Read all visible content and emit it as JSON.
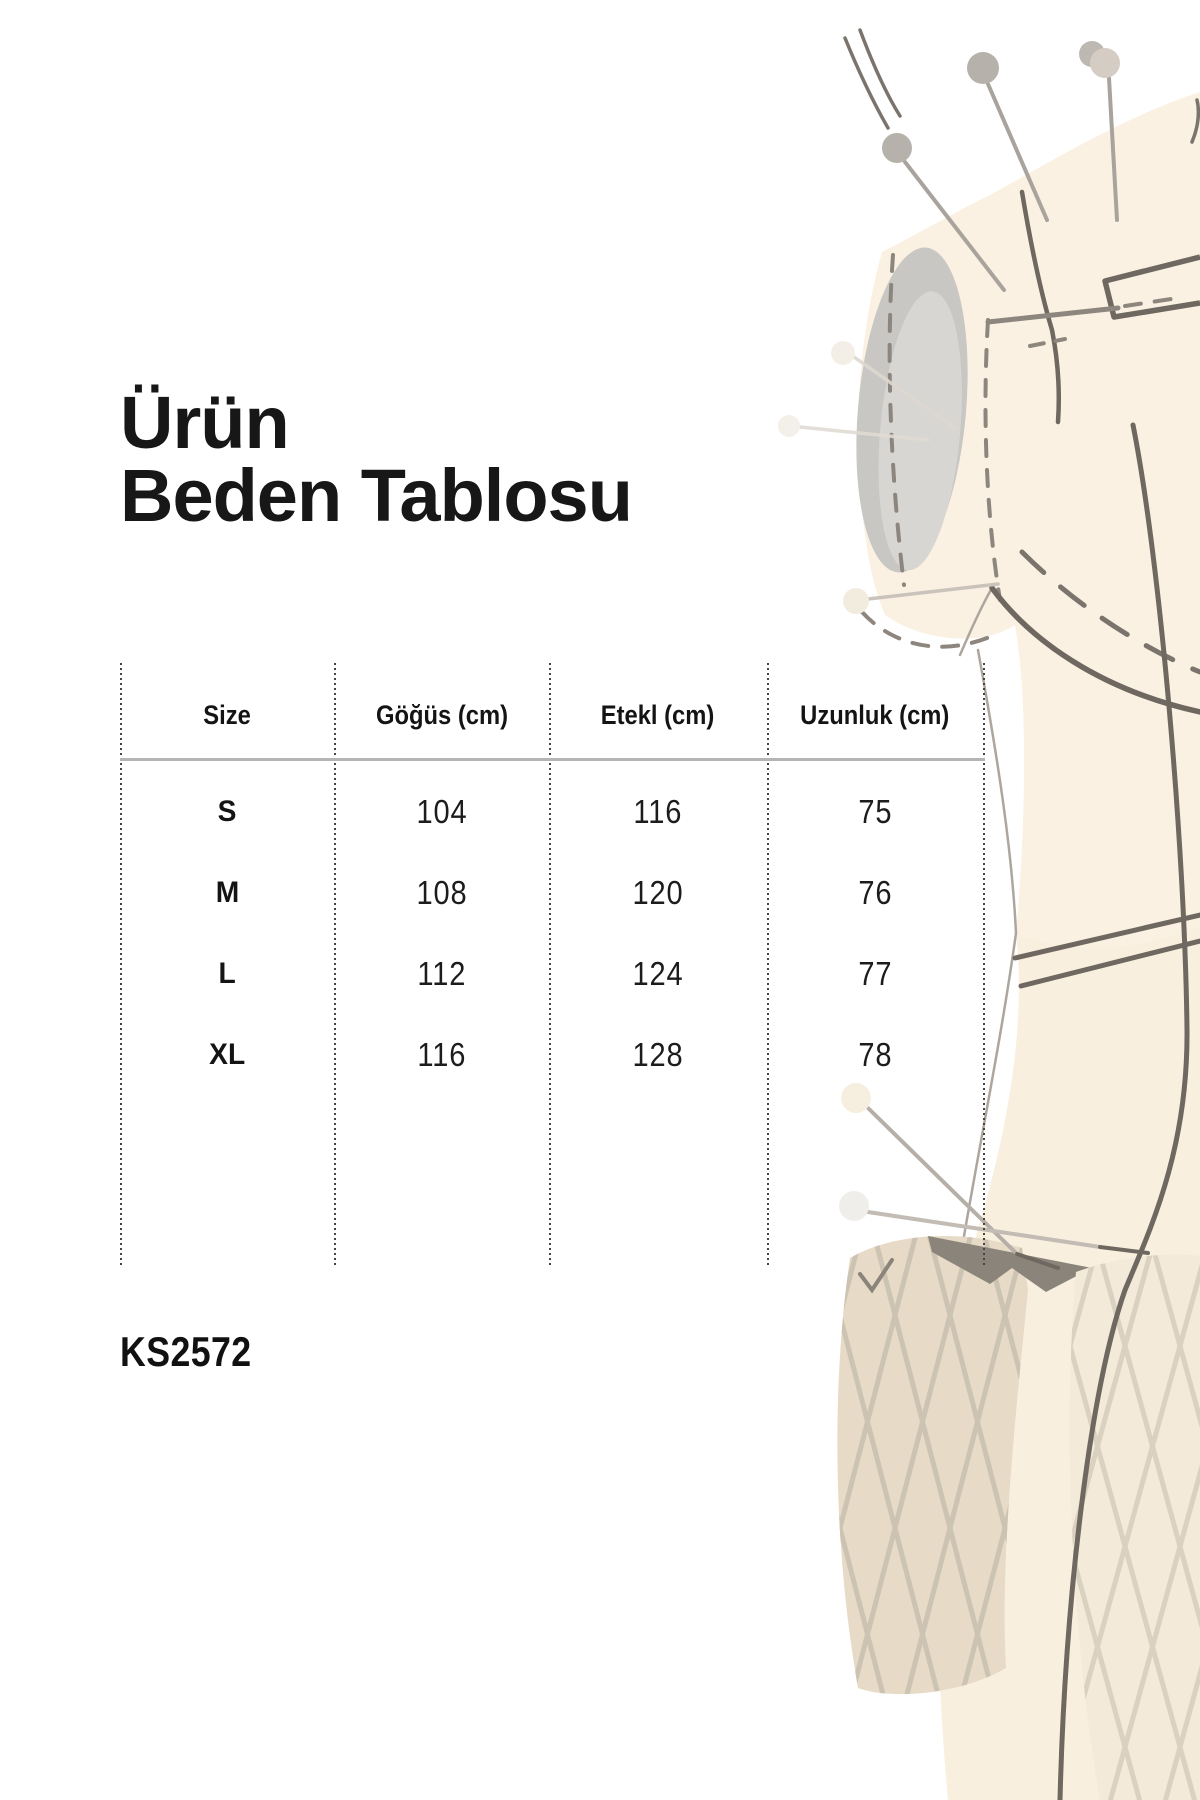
{
  "title": {
    "line1": "Ürün",
    "line2": "Beden Tablosu"
  },
  "size_table": {
    "headers": [
      "Size",
      "Göğüs (cm)",
      "Etekl (cm)",
      "Uzunluk (cm)"
    ],
    "rows": [
      {
        "size": "S",
        "chest": "104",
        "skirt": "116",
        "length": "75"
      },
      {
        "size": "M",
        "chest": "108",
        "skirt": "120",
        "length": "76"
      },
      {
        "size": "L",
        "chest": "112",
        "skirt": "124",
        "length": "77"
      },
      {
        "size": "XL",
        "chest": "116",
        "skirt": "128",
        "length": "78"
      }
    ]
  },
  "product_code": "KS2572",
  "chart_data": {
    "type": "table",
    "title": "Ürün Beden Tablosu",
    "columns": [
      "Size",
      "Göğüs (cm)",
      "Etekl (cm)",
      "Uzunluk (cm)"
    ],
    "rows": [
      [
        "S",
        104,
        116,
        75
      ],
      [
        "M",
        108,
        120,
        76
      ],
      [
        "L",
        112,
        124,
        77
      ],
      [
        "XL",
        116,
        128,
        78
      ]
    ]
  },
  "colors": {
    "text": "#141414",
    "dotted_divider": "#454545",
    "header_rule": "#b5b5b5",
    "illustration_cream": "#faf1e2",
    "illustration_outline": "#6f6860",
    "pin_gray": "#b6b1ab",
    "pin_beige": "#d5cdc3",
    "quilt_beige": "#e7dbc7"
  }
}
